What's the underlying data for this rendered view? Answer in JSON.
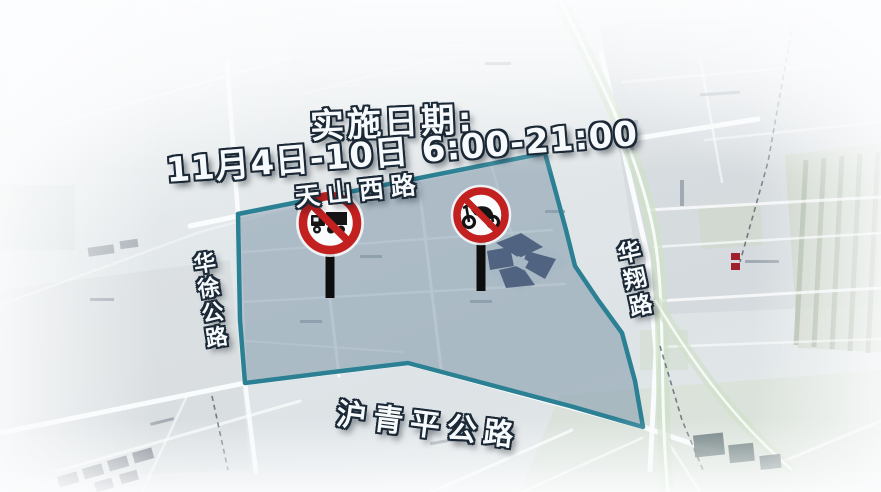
{
  "notice": {
    "title": "实施日期:",
    "schedule": "11月4日-10日 6:00-21:00"
  },
  "roads": {
    "top": "天山西路",
    "left": "华徐公路",
    "right": "华翔路",
    "bottom": "沪青平公路"
  },
  "signs": {
    "left_sign": "no-tricycle-truck-prohibition-sign",
    "right_sign": "no-motorcycle-prohibition-sign"
  },
  "colors": {
    "zone_border": "#2b8094",
    "zone_fill": "rgba(122,147,166,0.52)",
    "prohibition_red": "#c32020",
    "label_text": "#f7fafc",
    "label_outline": "#1b2836"
  }
}
